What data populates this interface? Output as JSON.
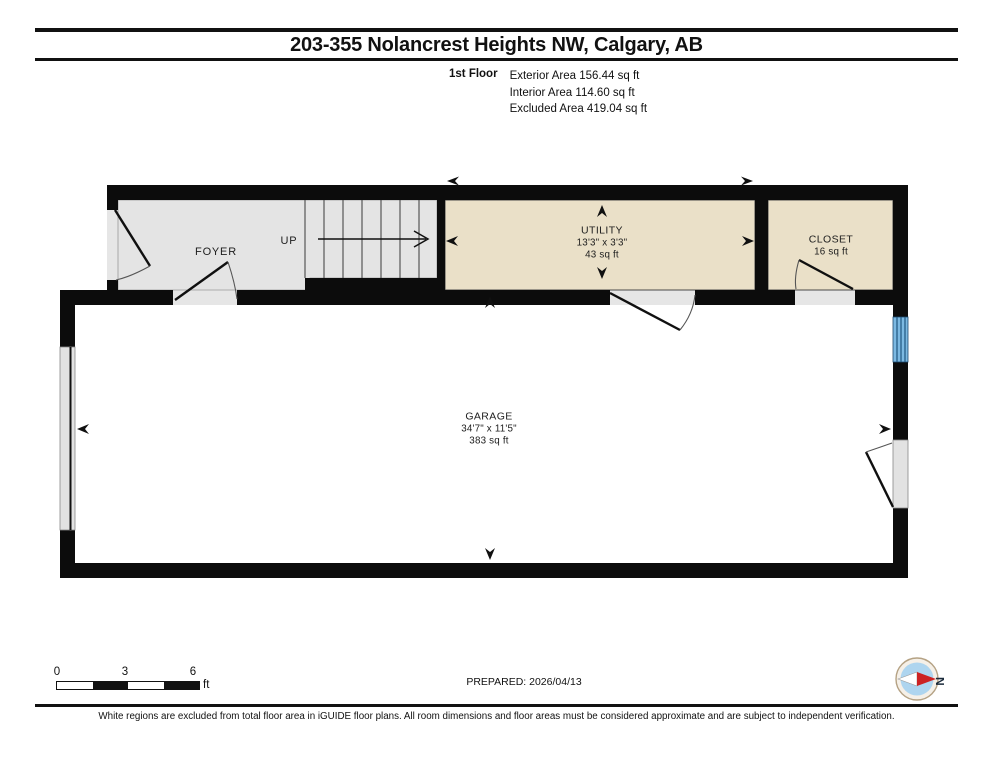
{
  "header": {
    "title": "203-355 Nolancrest Heights NW, Calgary, AB",
    "floor_label": "1st Floor",
    "area_lines": [
      "Exterior Area 156.44 sq ft",
      "Interior Area 114.60 sq ft",
      "Excluded Area 419.04 sq ft"
    ]
  },
  "floorplan": {
    "foyer": {
      "name": "FOYER"
    },
    "stairs": {
      "direction_label": "UP"
    },
    "utility": {
      "name": "UTILITY",
      "dimensions": "13'3\" x 3'3\"",
      "area": "43 sq ft"
    },
    "closet": {
      "name": "CLOSET",
      "area": "16 sq ft"
    },
    "garage": {
      "name": "GARAGE",
      "dimensions": "34'7\" x 11'5\"",
      "area": "383 sq ft"
    }
  },
  "footer": {
    "scale_ticks": [
      "0",
      "3",
      "6"
    ],
    "scale_unit": "ft",
    "prepared_label": "PREPARED: 2026/04/13",
    "compass_letter": "N",
    "disclaimer": "White regions are excluded from total floor area in iGUIDE floor plans. All room dimensions and floor areas must be considered approximate and are subject to independent verification."
  },
  "colors": {
    "wall": "#0c0c0c",
    "room_tan": "#eae0c8",
    "room_gray": "#e4e4e4",
    "window_blue": "#7cb9e2",
    "compass_red": "#cc2222",
    "compass_blue": "#aed5ef"
  }
}
